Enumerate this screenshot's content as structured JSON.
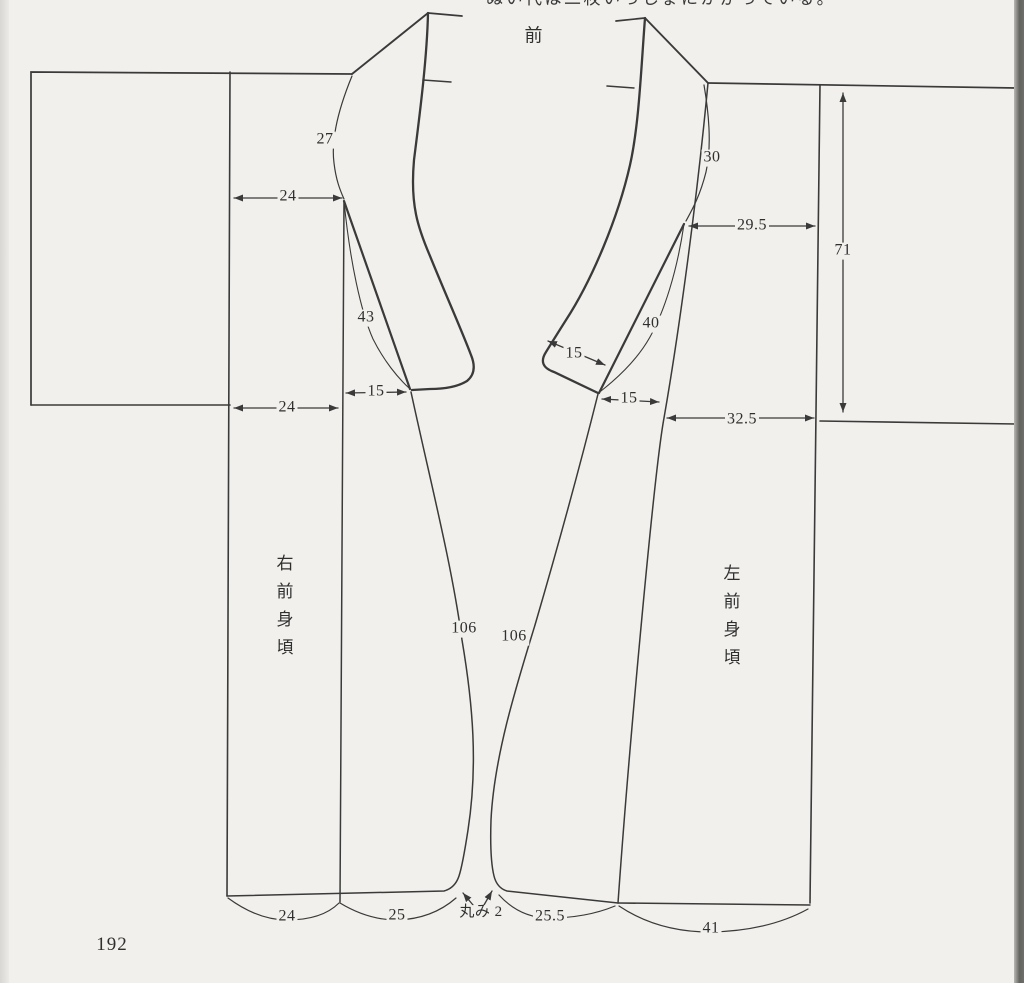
{
  "page": {
    "number": "192",
    "title_front": "前",
    "top_cropped_text": "ぬい代は二枚いっしょにかがっている。"
  },
  "pieces": {
    "right_front_body_label": "右前身頃",
    "left_front_body_label": "左前身頃"
  },
  "labels": {
    "dim27": "27",
    "dim24_upper": "24",
    "dim43": "43",
    "dim15_left": "15",
    "dim24_lower": "24",
    "dim106_left": "106",
    "dim106_right": "106",
    "dim30": "30",
    "dim29_5": "29.5",
    "dim71": "71",
    "dim15_diag": "15",
    "dim40": "40",
    "dim15_right": "15",
    "dim32_5": "32.5",
    "marumi": "丸み 2",
    "hem24": "24",
    "hem25": "25",
    "hem25_5": "25.5",
    "hem41": "41"
  },
  "measurement_values": {
    "right_front_piece": [
      "27",
      "24",
      "43",
      "15",
      "24",
      "106",
      "24",
      "25"
    ],
    "left_front_piece": [
      "30",
      "29.5",
      "71",
      "40",
      "15",
      "15",
      "32.5",
      "106",
      "25.5",
      "41"
    ],
    "hem_corner_rounding": "丸み 2"
  },
  "colors": {
    "paper": "#f1f0ed",
    "ink": "#3a3a3a",
    "right_edge_shadow": "#636360",
    "left_gutter_shadow": "#d8d7d4"
  }
}
